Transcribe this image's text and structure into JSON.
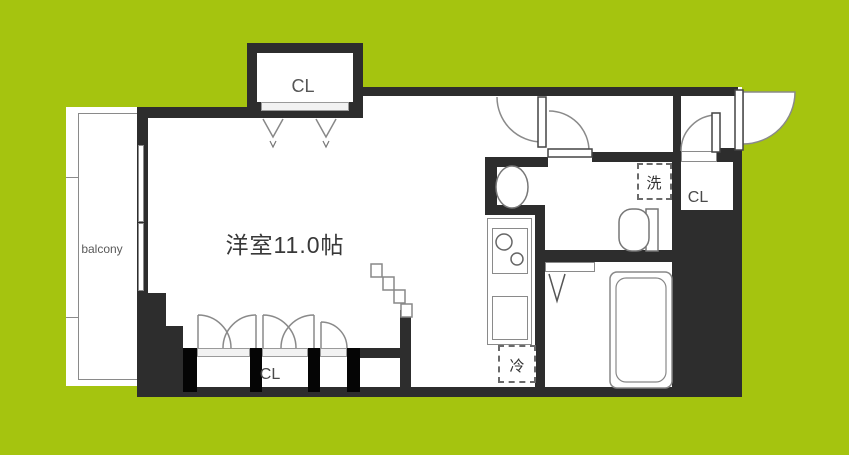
{
  "floorplan": {
    "colors": {
      "background": "#a5c40f",
      "wall": "#2d2d2d",
      "closet_pillar": "#050505",
      "fixture_line": "#888888"
    },
    "labels": {
      "balcony": "balcony",
      "main_room": "洋室11.0帖",
      "closet_top": "CL",
      "closet_bottom": "CL",
      "closet_entry": "CL",
      "washing_machine": "洗",
      "refrigerator": "冷"
    }
  }
}
